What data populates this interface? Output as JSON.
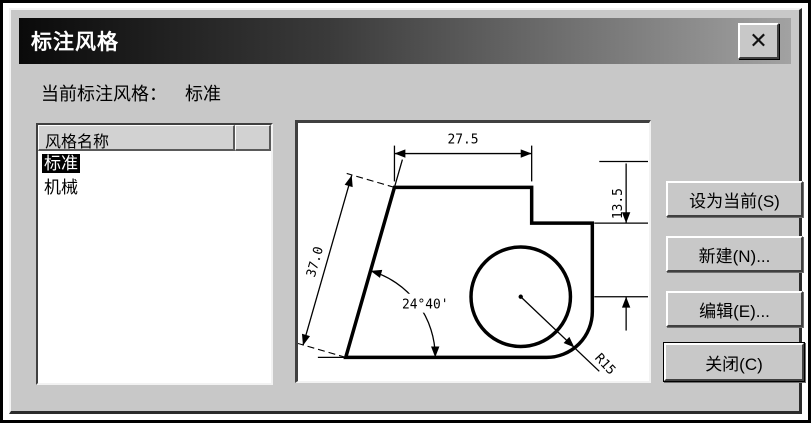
{
  "window": {
    "title": "标注风格",
    "close_icon": "✕"
  },
  "current": {
    "label": "当前标注风格：",
    "value": "标准"
  },
  "style_list": {
    "header": "风格名称",
    "items": [
      {
        "name": "标准",
        "selected": true
      },
      {
        "name": "机械",
        "selected": false
      }
    ]
  },
  "preview": {
    "dims": {
      "width": "27.5",
      "step": "13.5",
      "slant": "37.0",
      "angle": "24°40'",
      "radius": "R15"
    }
  },
  "buttons": {
    "set_current": "设为当前(S)",
    "new": "新建(N)...",
    "edit": "编辑(E)...",
    "close": "关闭(C)"
  },
  "colors": {
    "dialog_bg": "#c8c8c8",
    "titlebar_start": "#0a0a0a",
    "titlebar_end": "#a2a2a2",
    "selection_bg": "#000000",
    "selection_fg": "#ffffff"
  }
}
